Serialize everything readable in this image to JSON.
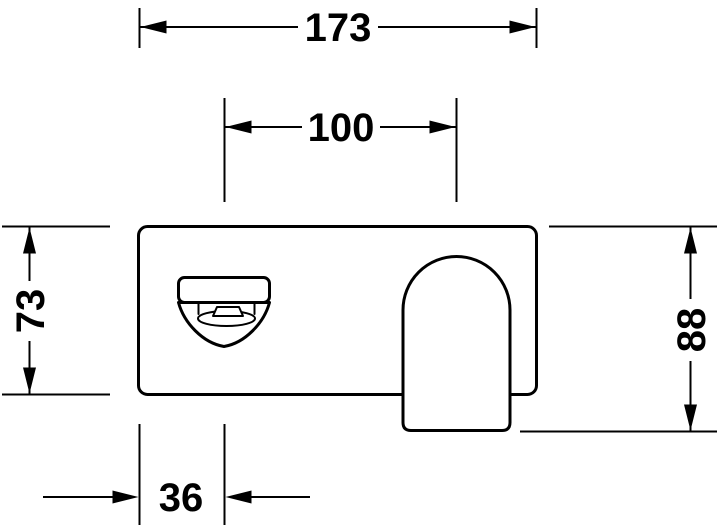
{
  "drawing": {
    "title": "faucet-front-elevation-technical-drawing",
    "background_color": "#ffffff",
    "line_color": "#000000",
    "components": {
      "plate": "wall plate",
      "spout": "spout underside with aerator",
      "handle": "lever handle"
    },
    "dimensions": {
      "overall_width": "173",
      "spout_center_to_handle_center": "100",
      "plate_height": "73",
      "overall_height": "88",
      "left_edge_to_spout_center": "36"
    }
  }
}
